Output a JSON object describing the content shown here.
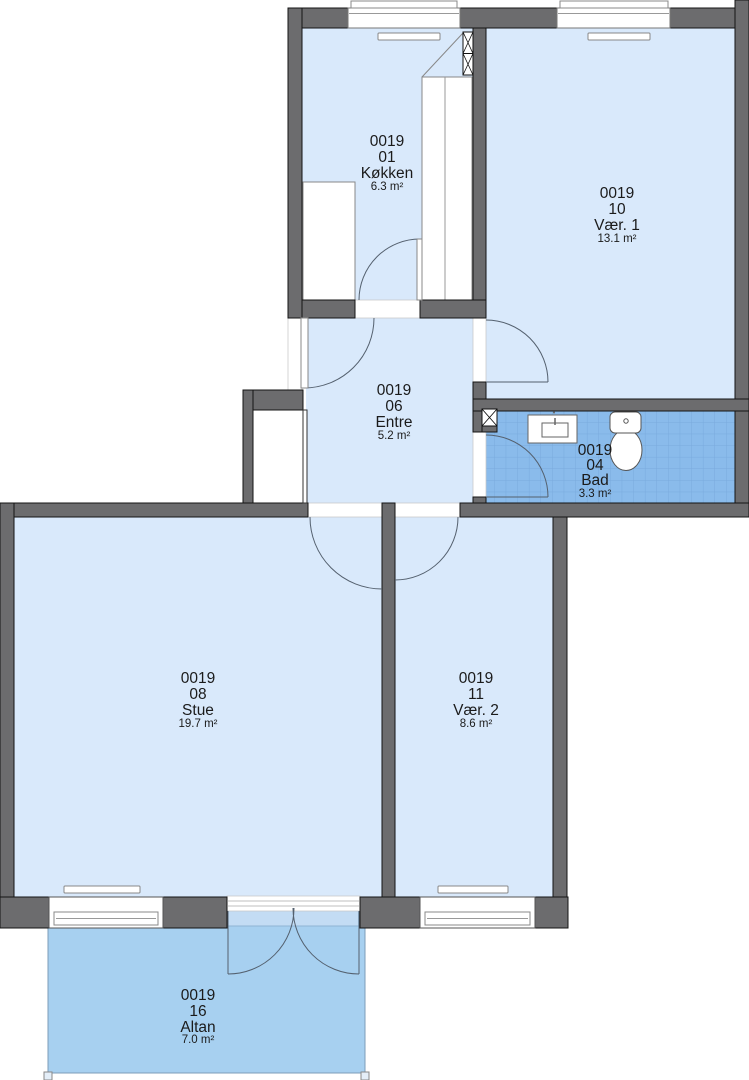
{
  "plan": {
    "rooms": [
      {
        "code": "0019",
        "number": "01",
        "name": "Køkken",
        "area": "6.3 m²"
      },
      {
        "code": "0019",
        "number": "10",
        "name": "Vær. 1",
        "area": "13.1 m²"
      },
      {
        "code": "0019",
        "number": "06",
        "name": "Entre",
        "area": "5.2 m²"
      },
      {
        "code": "0019",
        "number": "04",
        "name": "Bad",
        "area": "3.3 m²"
      },
      {
        "code": "0019",
        "number": "08",
        "name": "Stue",
        "area": "19.7 m²"
      },
      {
        "code": "0019",
        "number": "11",
        "name": "Vær. 2",
        "area": "8.6 m²"
      },
      {
        "code": "0019",
        "number": "16",
        "name": "Altan",
        "area": "7.0 m²"
      }
    ],
    "colors": {
      "wall": "#6c6c6e",
      "wall_outline": "#141414",
      "room_fill": "#d9e9fb",
      "balcony_fill": "#a7d0f0",
      "balcony_strip": "#c3dcf4",
      "bath_tile": "#8abbeb",
      "tile_grid_line": "#6b9cd2",
      "text": "#1b1b1b"
    }
  }
}
